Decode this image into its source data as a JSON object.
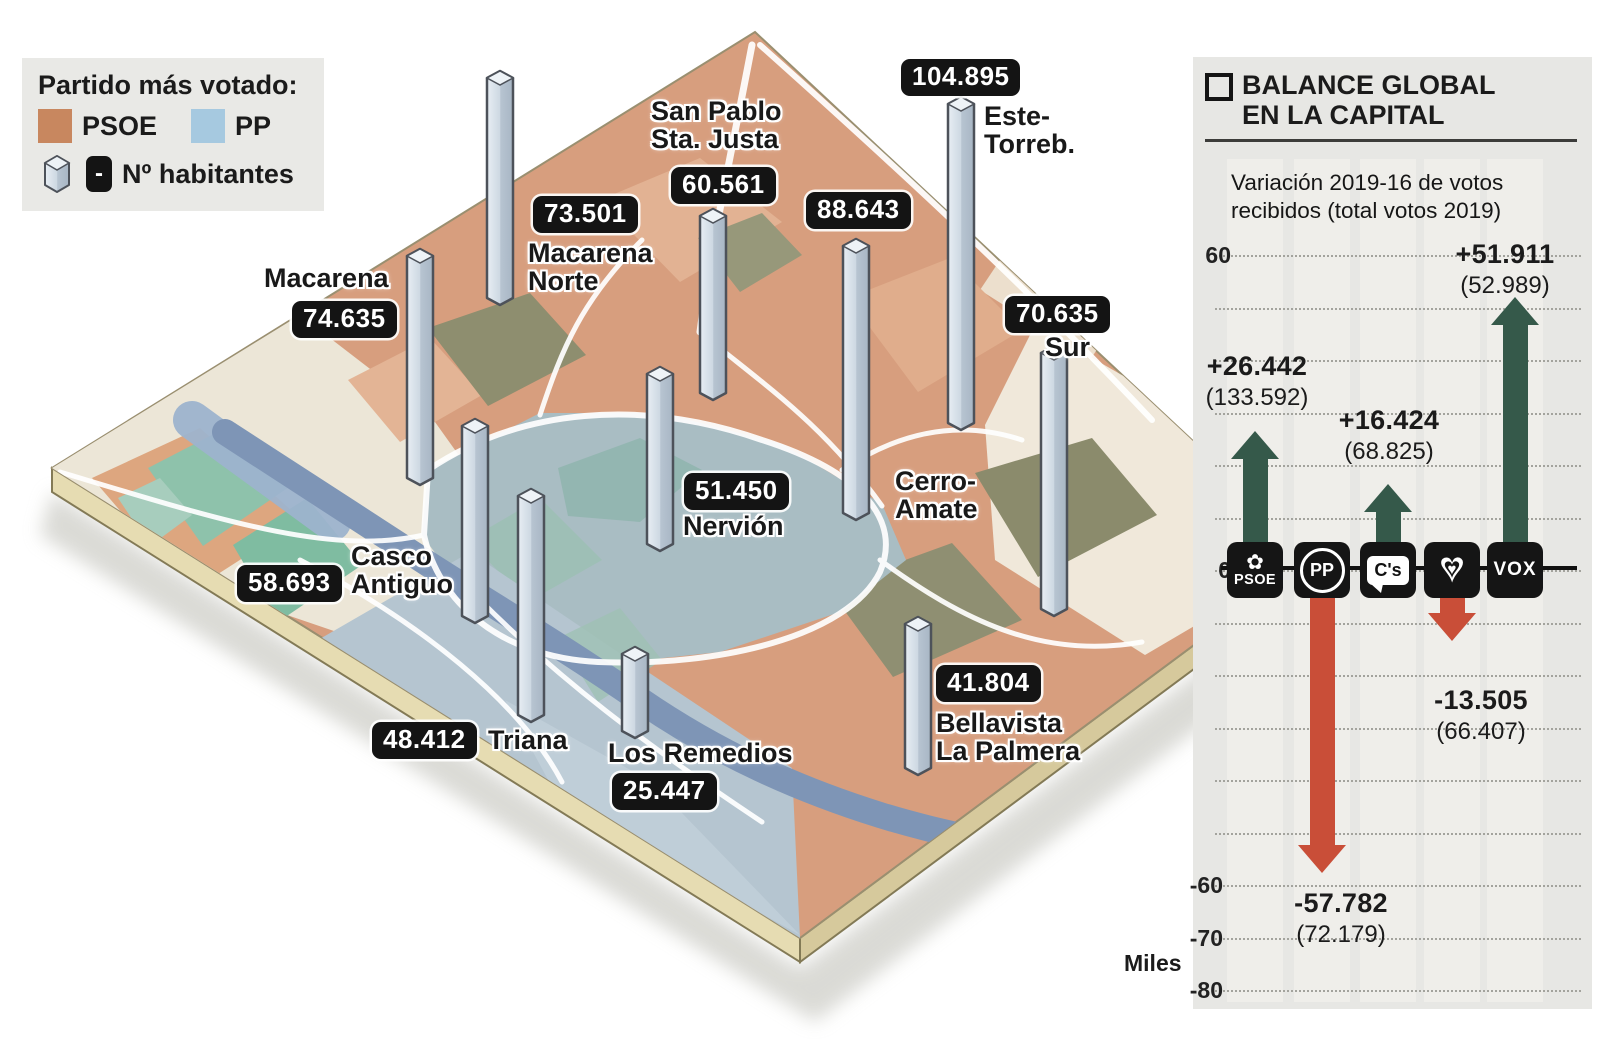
{
  "legend": {
    "title": "Partido más votado:",
    "parties": [
      {
        "label": "PSOE",
        "color": "#c8875f"
      },
      {
        "label": "PP",
        "color": "#a6c9e0"
      }
    ],
    "habitantes": {
      "label": "Nº habitantes",
      "badge": "-"
    }
  },
  "map": {
    "districts": [
      {
        "name": "Macarena",
        "value": "74.635",
        "winner": "PSOE"
      },
      {
        "name": "Macarena\nNorte",
        "value": "73.501",
        "winner": "PSOE"
      },
      {
        "name": "San Pablo\nSta. Justa",
        "value": "60.561",
        "winner": "PSOE"
      },
      {
        "name": "Este-\nTorreb.",
        "value": "104.895",
        "winner": "PSOE"
      },
      {
        "name": "Cerro-\nAmate",
        "value": "88.643",
        "winner": "PSOE"
      },
      {
        "name": "Sur",
        "value": "70.635",
        "winner": "PSOE"
      },
      {
        "name": "Nervión",
        "value": "51.450",
        "winner": "PP"
      },
      {
        "name": "Casco\nAntiguo",
        "value": "58.693",
        "winner": "PP"
      },
      {
        "name": "Triana",
        "value": "48.412",
        "winner": "PP"
      },
      {
        "name": "Los Remedios",
        "value": "25.447",
        "winner": "PP"
      },
      {
        "name": "Bellavista\nLa Palmera",
        "value": "41.804",
        "winner": "PSOE"
      }
    ],
    "psoe_map_color": "#d79e7e",
    "pp_map_color": "#a9bdc3"
  },
  "panel": {
    "title": "BALANCE GLOBAL\nEN LA CAPITAL",
    "subtitle": "Variación 2019-16 de votos\nrecibidos (total votos 2019)",
    "unit_label": "Miles",
    "yticks": [
      "60",
      "0",
      "-60",
      "-70",
      "-80"
    ],
    "parties": [
      {
        "name": "PSOE",
        "icon_text": "PSOE",
        "emblem": "✿",
        "delta": "+26.442",
        "total": "(133.592)"
      },
      {
        "name": "PP",
        "icon_text": "PP",
        "delta": "-57.782",
        "total": "(72.179)"
      },
      {
        "name": "Ciudadanos",
        "icon_text": "C's",
        "delta": "+16.424",
        "total": "(68.825)"
      },
      {
        "name": "Podemos",
        "icon_text": "♥",
        "delta": "-13.505",
        "total": "(66.407)"
      },
      {
        "name": "VOX",
        "icon_text": "VOX",
        "delta": "+51.911",
        "total": "(52.989)"
      }
    ],
    "colors": {
      "positive": "#35594a",
      "negative": "#c94e38"
    }
  },
  "chart_data": [
    {
      "type": "bar",
      "title": "Balance global en la capital",
      "subtitle": "Variación 2019-16 de votos recibidos (total votos 2019)",
      "categories": [
        "PSOE",
        "PP",
        "C's",
        "Podemos",
        "VOX"
      ],
      "series": [
        {
          "name": "Variación de votos 2019-2016 (miles)",
          "values": [
            26.442,
            -57.782,
            16.424,
            -13.505,
            51.911
          ]
        }
      ],
      "data_labels": [
        "+26.442",
        "-57.782",
        "+16.424",
        "-13.505",
        "+51.911"
      ],
      "totals_votos_2019": [
        "(133.592)",
        "(72.179)",
        "(68.825)",
        "(66.407)",
        "(52.989)"
      ],
      "ylabel": "Miles",
      "yticks": [
        60,
        0,
        -60,
        -70,
        -80
      ],
      "ylim": [
        -80,
        60
      ],
      "grid": "dotted-horizontal-every-10",
      "legend_position": "none",
      "bar_style": "arrows",
      "positive_color": "#35594a",
      "negative_color": "#c94e38"
    },
    {
      "type": "bar",
      "title": "Nº habitantes por distrito (prismas sobre mapa isométrico de Sevilla)",
      "categories": [
        "Macarena",
        "Macarena Norte",
        "San Pablo Sta. Justa",
        "Este-Torreb.",
        "Cerro-Amate",
        "Sur",
        "Nervión",
        "Casco Antiguo",
        "Triana",
        "Los Remedios",
        "Bellavista La Palmera"
      ],
      "values": [
        74635,
        73501,
        60561,
        104895,
        88643,
        70635,
        51450,
        58693,
        48412,
        25447,
        41804
      ]
    }
  ]
}
